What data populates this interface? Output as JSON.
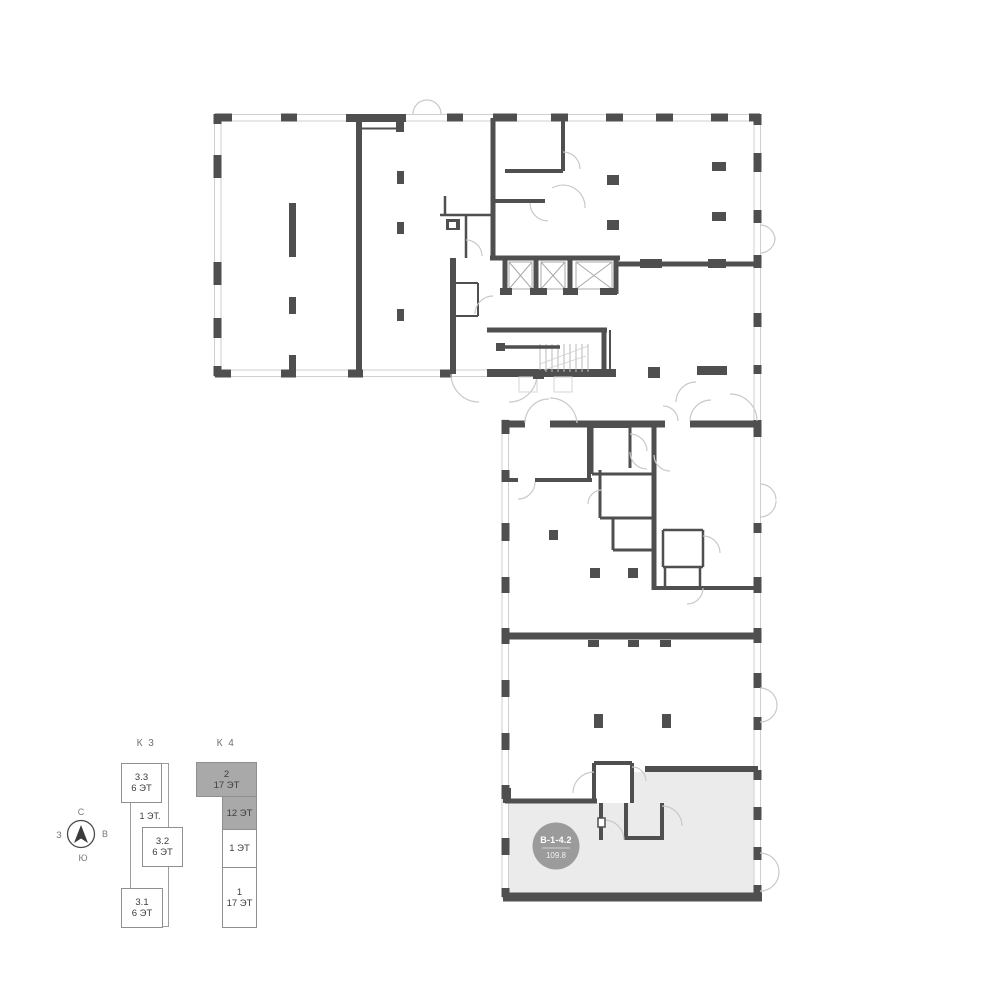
{
  "floor_plan": {
    "unit_badge": {
      "code": "В-1-4.2",
      "area": "109.8"
    }
  },
  "legend": {
    "k3": {
      "title": "К 3",
      "b33": {
        "l1": "3.3",
        "l2": "6 ЭТ"
      },
      "floor1": "1 ЭТ.",
      "b32": {
        "l1": "3.2",
        "l2": "6 ЭТ"
      },
      "b31": {
        "l1": "3.1",
        "l2": "6 ЭТ"
      }
    },
    "k4": {
      "title": "К 4",
      "b2": {
        "l1": "2",
        "l2": "17 ЭТ"
      },
      "b12": {
        "l1": "12 ЭТ",
        "l2": ""
      },
      "b1f": {
        "l1": "1 ЭТ",
        "l2": ""
      },
      "b1": {
        "l1": "1",
        "l2": "17 ЭТ"
      }
    }
  },
  "compass": {
    "n": "С",
    "e": "В",
    "s": "Ю",
    "w": "З"
  },
  "colors": {
    "wall": "#4f4f4f",
    "window_line": "#cfcfcf",
    "door_arc": "#c9c9c9",
    "highlight": "#ebebeb",
    "badge_bg": "#9b9b9b",
    "selected_block_bg": "#a9a9a9"
  }
}
